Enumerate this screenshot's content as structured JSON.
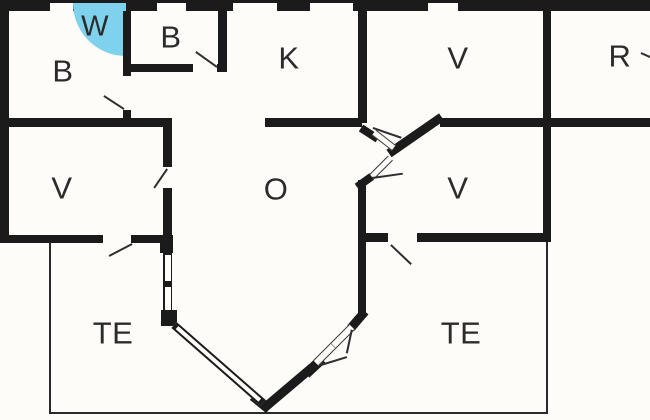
{
  "title": "Holiday home floor plan",
  "colors": {
    "wall": "#1b1b1b",
    "wet_cell_blue": "#7fd2ee",
    "background": "#fdfcf8",
    "label_text": "#2b2b2b"
  },
  "rooms": [
    {
      "id": "bedroom-top-left",
      "label": "B"
    },
    {
      "id": "wet-cell",
      "label": "W"
    },
    {
      "id": "bedroom-top-second",
      "label": "B"
    },
    {
      "id": "kitchen",
      "label": "K"
    },
    {
      "id": "room-top-right-v",
      "label": "V"
    },
    {
      "id": "room-r",
      "label": "R"
    },
    {
      "id": "room-left-v",
      "label": "V"
    },
    {
      "id": "living-room-o",
      "label": "O"
    },
    {
      "id": "room-right-v",
      "label": "V"
    },
    {
      "id": "terrace-left",
      "label": "TE"
    },
    {
      "id": "terrace-right",
      "label": "TE"
    }
  ]
}
